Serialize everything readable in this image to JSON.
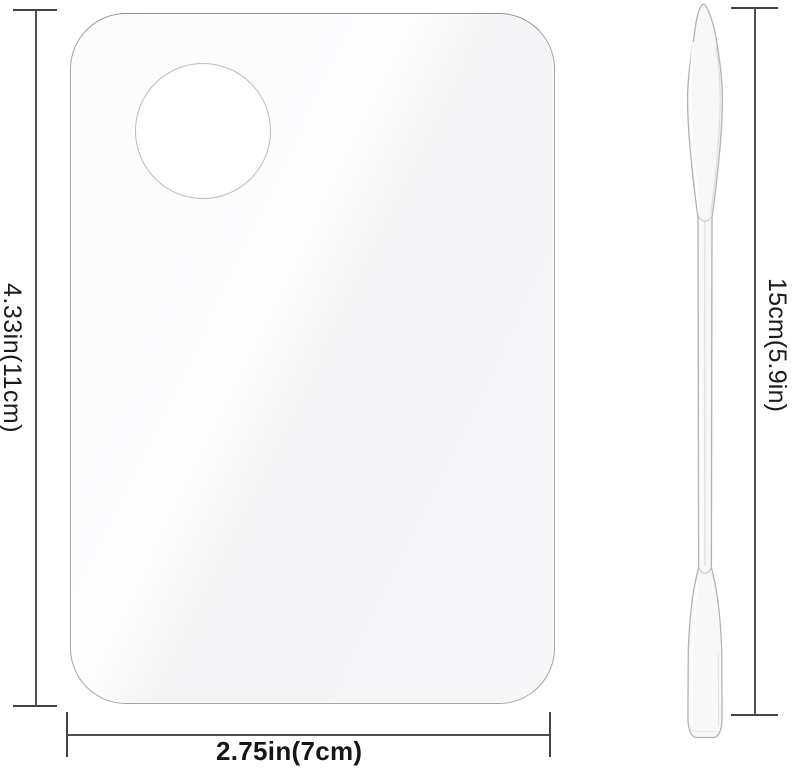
{
  "diagram": {
    "type": "product-dimension-diagram",
    "palette": {
      "height_dimension": "4.33in(11cm)",
      "width_dimension": "2.75in(7cm)"
    },
    "spatula": {
      "length_dimension": "15cm(5.9in)"
    },
    "colors": {
      "background": "#ffffff",
      "dimension_line": "#4f4f4f",
      "dimension_cap": "#434343",
      "label_text": "#1b1b1b",
      "palette_outline": "#a5a5a9",
      "palette_fill": "#f7f7f9",
      "thumb_hole_fill": "#ffffff",
      "spatula_outline": "#b3b3b7"
    }
  }
}
